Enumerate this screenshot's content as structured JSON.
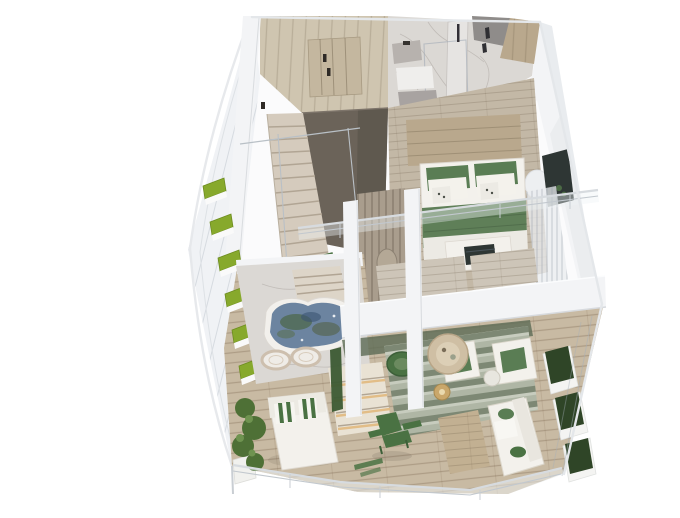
{
  "canvas": {
    "width": 680,
    "height": 486
  },
  "scene": {
    "type": "isometric-3d-apartment-cutaway-render",
    "levels": [
      "upper-floor",
      "lower-floor"
    ],
    "objects": [
      {
        "id": "wardrobe-room",
        "label": "wardrobe room with wood closet"
      },
      {
        "id": "closet-doors",
        "label": "closet doors with dark handles"
      },
      {
        "id": "staircase",
        "label": "wood staircase"
      },
      {
        "id": "stair-feature-wall",
        "label": "dark feature wall"
      },
      {
        "id": "bathroom",
        "label": "marble bathroom"
      },
      {
        "id": "vanity",
        "label": "vanity and fixtures"
      },
      {
        "id": "shower-glass",
        "label": "glass shower partition"
      },
      {
        "id": "bedroom",
        "label": "bedroom"
      },
      {
        "id": "double-bed",
        "label": "double bed with green pillows"
      },
      {
        "id": "foot-bench",
        "label": "bench with dark tv unit"
      },
      {
        "id": "tv-inset",
        "label": "recessed media niche"
      },
      {
        "id": "sheer-curtain",
        "label": "sheer curtain"
      },
      {
        "id": "glass-balustrade",
        "label": "glass balustrade"
      },
      {
        "id": "structural-beam",
        "label": "white slab edge beam"
      },
      {
        "id": "pillars",
        "label": "white pillars"
      },
      {
        "id": "terrace-marble",
        "label": "marble terrace"
      },
      {
        "id": "plunge-pool",
        "label": "plunge pool with mottled water"
      },
      {
        "id": "round-loungers",
        "label": "two ring loungers"
      },
      {
        "id": "lit-steps",
        "label": "illuminated marble steps"
      },
      {
        "id": "wood-deck",
        "label": "timber deck"
      },
      {
        "id": "daybed",
        "label": "white daybed with striped pillows"
      },
      {
        "id": "planter-bushes",
        "label": "leafy corner plants"
      },
      {
        "id": "adirondack-chair",
        "label": "green deck chair"
      },
      {
        "id": "living-rug",
        "label": "striped area rug"
      },
      {
        "id": "papasan-chair",
        "label": "green round chair"
      },
      {
        "id": "coffee-table",
        "label": "round wood coffee table"
      },
      {
        "id": "lounge-seats",
        "label": "white seats with green cushions"
      },
      {
        "id": "rattan-lamp",
        "label": "rattan floor lamp"
      },
      {
        "id": "outdoor-sofa",
        "label": "outdoor sofa with green bolsters"
      },
      {
        "id": "outdoor-table",
        "label": "low wood table"
      },
      {
        "id": "grass-planters",
        "label": "stepped grass planters on left facade"
      },
      {
        "id": "hedge-planters",
        "label": "hedge boxes on right facade"
      },
      {
        "id": "glass-facades",
        "label": "full-height glazing"
      }
    ]
  },
  "palette": {
    "background": "#ffffff",
    "wall": "#f3f4f6",
    "wallShade": "#e4e7ea",
    "woodLight": "#cfc5b0",
    "woodMid": "#b9a88d",
    "woodFloor": "#c3b8a6",
    "woodDeck": "#c8baa3",
    "darkWall": "#6b6359",
    "marble": "#dbd8d4",
    "glass": "#eef1f4",
    "furnGreen": "#5a7d54",
    "furnGreenDark": "#4a7243",
    "throwGreen": "#5f7f58",
    "grass": "#87a92c",
    "hedge": "#2f4527",
    "bush": "#4e7036",
    "pool": "#6c84a0",
    "poolMottle": "#4d684c",
    "blueGlass": "#5b79a4",
    "darkScreen": "#2e3634",
    "furnWhite": "#f3f1ec",
    "benchWood": "#b3a085",
    "warm": "#e2b97f"
  }
}
